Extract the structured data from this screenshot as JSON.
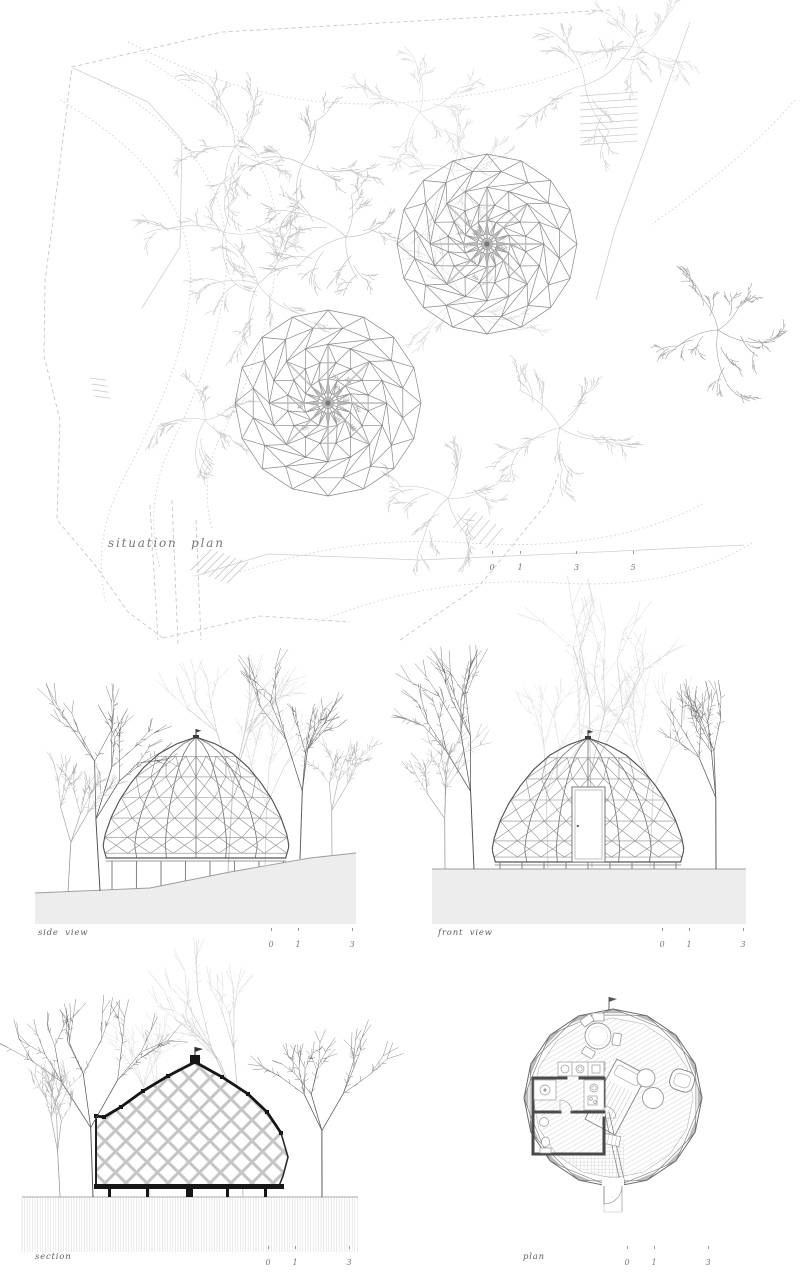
{
  "sheet": {
    "kind": "architectural drawing sheet",
    "background": "#ffffff"
  },
  "views": {
    "situation": {
      "label": "situation plan",
      "scale": {
        "numbers": [
          0,
          1,
          3,
          5
        ],
        "unit_px": 28.2
      }
    },
    "side": {
      "label": "side view",
      "scale": {
        "numbers": [
          0,
          1,
          3
        ],
        "unit_px": 27
      }
    },
    "front": {
      "label": "front view",
      "scale": {
        "numbers": [
          0,
          1,
          3
        ],
        "unit_px": 27
      }
    },
    "section": {
      "label": "section",
      "scale": {
        "numbers": [
          0,
          1,
          3
        ],
        "unit_px": 27
      }
    },
    "plan": {
      "label": "plan",
      "scale": {
        "numbers": [
          0,
          1,
          3
        ],
        "unit_px": 27
      }
    }
  },
  "colors": {
    "line_dark": "#3f3f3f",
    "line_mid": "#8a8a8a",
    "line_light": "#c9c9c9",
    "contour": "#cccccc",
    "boundary": "#c2c2c2",
    "tree_dark": "#4f4f4f",
    "tree_mid": "#9a9a9a",
    "tree_light": "#c7c7c7",
    "tree_xlight": "#d6d6d6",
    "ground_fill": "#ededed",
    "ground_edge": "#9c9c9c",
    "hatch": "#dcdcdc",
    "section_cut": "#161616",
    "lattice": "#cccccc",
    "furniture": "#999999",
    "wall": "#4a4a4a",
    "label_text": "#6b6b6b"
  }
}
